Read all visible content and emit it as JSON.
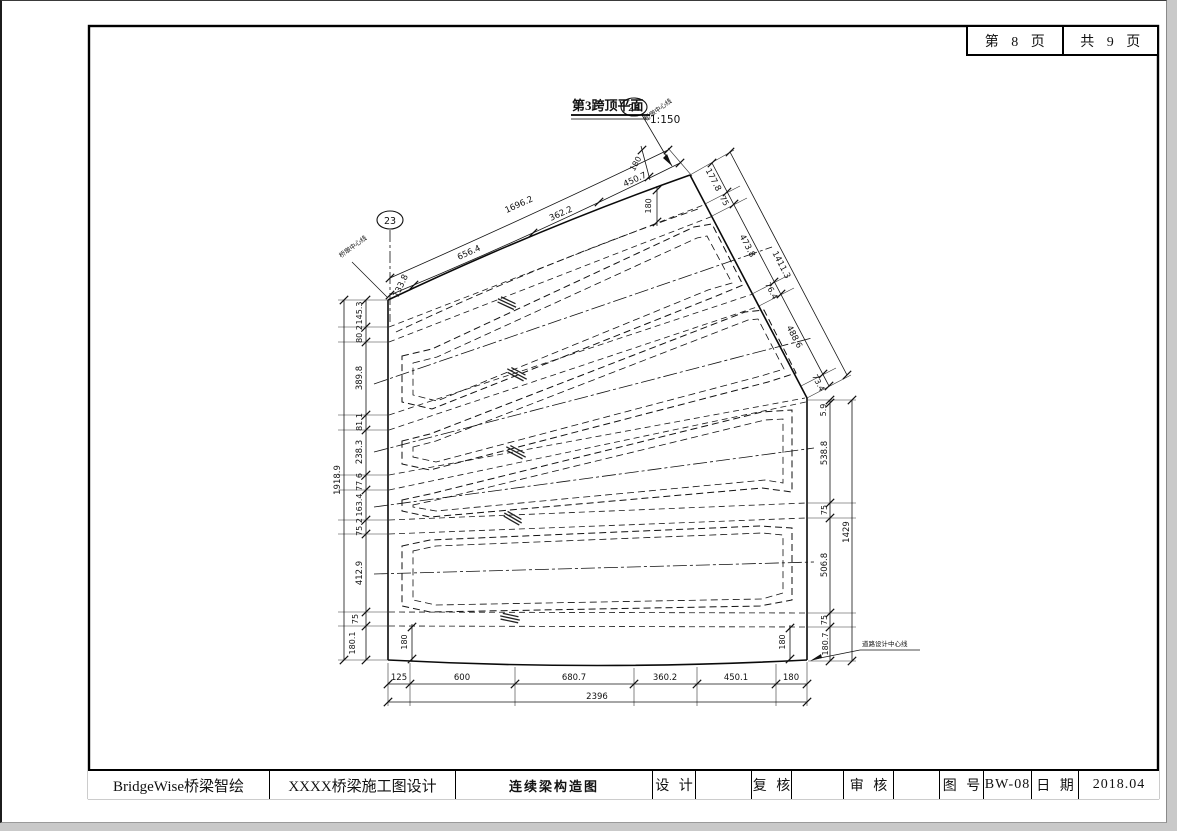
{
  "page_header": {
    "page_label": "第 8 页",
    "total_label": "共 9 页"
  },
  "drawing": {
    "title": "第3跨顶平面",
    "scale": "1:150",
    "pier_left_no": "23",
    "pier_right_no": "24",
    "pier_line_label_left": "桥墩中心线",
    "pier_line_label_right": "桥墩中心线",
    "road_center_label": "道路设计中心线"
  },
  "dims": {
    "top_total": "1696.2",
    "top_segs": [
      "133.8",
      "656.4",
      "362.2",
      "450.7"
    ],
    "top_offset_a": "180",
    "top_offset_b": "180",
    "skew_total": "1411.3",
    "skew_segs": [
      "177.8",
      "75",
      "473.8",
      "76.4",
      "488.6",
      "73.4"
    ],
    "right_total": "1429",
    "right_segs": [
      "5.9",
      "538.8",
      "75",
      "506.8",
      "75",
      "180.7"
    ],
    "left_total": "1918.9",
    "left_segs": [
      "145.3",
      "80.2",
      "389.8",
      "81.1",
      "238.3",
      "77.6",
      "163.4",
      "75.2",
      "412.9",
      "75",
      "180.1"
    ],
    "bottom_total": "2396",
    "bottom_segs": [
      "125",
      "600",
      "680.7",
      "360.2",
      "450.1",
      "180"
    ],
    "bottom_inner_left": "180",
    "bottom_inner_right": "180"
  },
  "titleblock": {
    "company": "BridgeWise桥梁智绘",
    "project": "XXXX桥梁施工图设计",
    "drawing_name": "连续梁构造图",
    "design_label": "设 计",
    "check_label": "复 核",
    "review_label": "审 核",
    "no_label": "图 号",
    "no_value": "BW-08",
    "date_label": "日 期",
    "date_value": "2018.04"
  }
}
